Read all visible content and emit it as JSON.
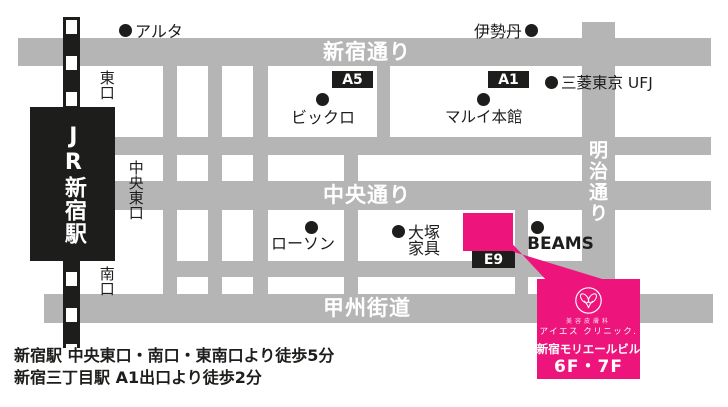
{
  "map": {
    "streets": {
      "shinjuku_dori": "新宿通り",
      "chuo_dori": "中央通り",
      "koshu_kaido": "甲州街道",
      "meiji_dori": "明治通り"
    },
    "station": {
      "name": "JR新宿駅",
      "exit_east": "東口",
      "exit_central_east": "中央東口",
      "exit_south": "南口"
    },
    "exit_badges": {
      "a5": "A5",
      "a1": "A1",
      "e9": "E9"
    },
    "landmarks": {
      "alta": "アルタ",
      "isetan": "伊勢丹",
      "mitsubishi_ufj": "三菱東京 UFJ",
      "bicqlo": "ビックロ",
      "marui": "マルイ本館",
      "lawson": "ローソン",
      "otsuka_line1": "大塚",
      "otsuka_line2": "家具",
      "beams": "BEAMS"
    }
  },
  "clinic": {
    "department": "美容皮膚科",
    "name": "アイエス クリニック.",
    "building": "新宿モリエールビル",
    "floors": "6F・7F"
  },
  "footer": {
    "line1": "新宿駅 中央東口・南口・東南口より徒歩5分",
    "line2": "新宿三丁目駅 A1出口より徒歩2分"
  },
  "colors": {
    "street_gray": "#b5b5b5",
    "ink_black": "#1d1d1b",
    "brand_pink": "#ed147b"
  }
}
